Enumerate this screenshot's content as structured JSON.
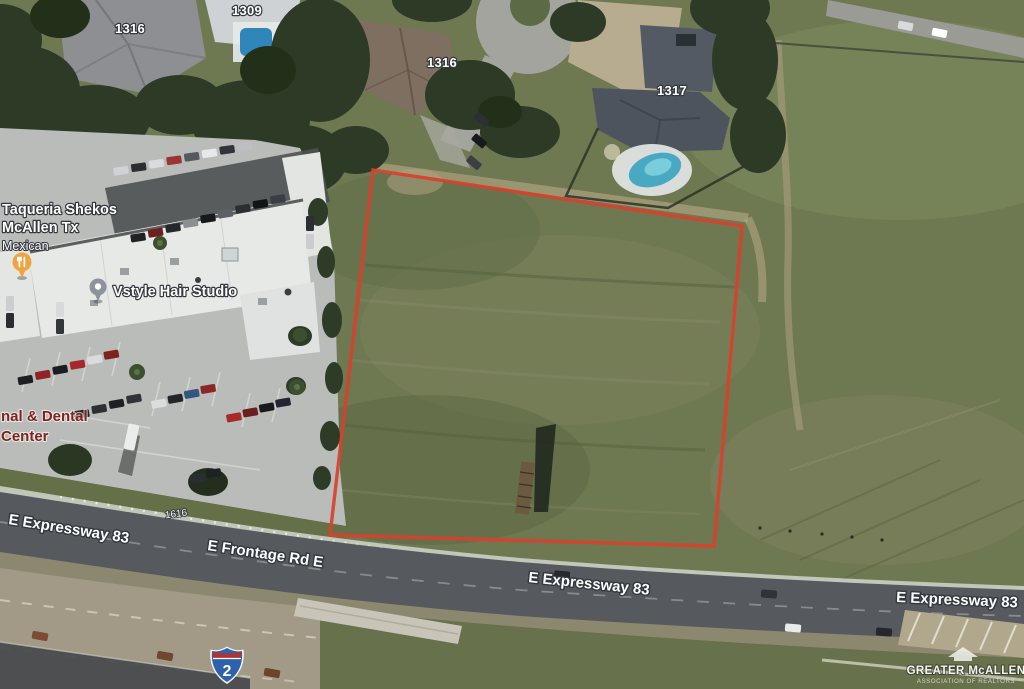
{
  "map": {
    "address_labels": {
      "h1309": "1309",
      "h1316_left": "1316",
      "h1316_mid": "1316",
      "h1317": "1317",
      "frontage_parcel": "1616"
    },
    "pois": {
      "restaurant": {
        "line1": "Taqueria Shekos",
        "line2": "McAllen Tx",
        "category": "Mexican",
        "icon": "restaurant-pin",
        "pin_color": "#efa53f"
      },
      "hair_studio": {
        "name": "Vstyle Hair Studio",
        "icon": "place-pin",
        "pin_color": "#8d939c"
      },
      "dental": {
        "line1": "nal & Dental",
        "line2": "Center",
        "label_color": "#7d241d"
      }
    },
    "road_labels": {
      "expressway_left": "E Expressway 83",
      "frontage_road": "E Frontage Rd E",
      "expressway_mid": "E Expressway 83",
      "expressway_right": "E Expressway 83"
    },
    "route_shield": {
      "type": "interstate",
      "number": "2",
      "body_color": "#2f62ad",
      "crest_color": "#b6322c"
    },
    "parcel_outline_color": "#d9402c",
    "watermark": {
      "title": "GREATER McALLEN",
      "subtitle": "ASSOCIATION OF REALTORS",
      "icon": "house-roof-icon"
    }
  }
}
